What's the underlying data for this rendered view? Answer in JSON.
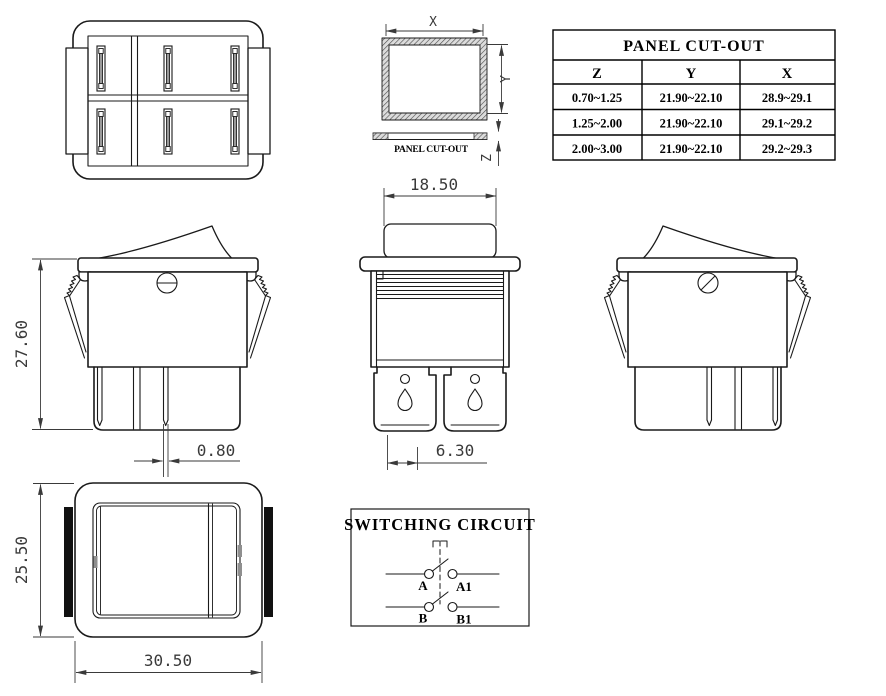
{
  "views": {
    "cutout_view": {
      "x_label": "X",
      "y_label": "Y",
      "z_label": "Z",
      "caption": "PANEL CUT-OUT"
    },
    "cutout_table": {
      "title": "PANEL CUT-OUT",
      "headers": [
        "Z",
        "Y",
        "X"
      ],
      "rows": [
        [
          "0.70~1.25",
          "21.90~22.10",
          "28.9~29.1"
        ],
        [
          "1.25~2.00",
          "21.90~22.10",
          "29.1~29.2"
        ],
        [
          "2.00~3.00",
          "21.90~22.10",
          "29.2~29.3"
        ]
      ]
    },
    "side_view": {
      "height": "27.60",
      "terminal_thickness": "0.80"
    },
    "front_view": {
      "rocker_width": "18.50",
      "terminal_width": "6.30"
    },
    "top_view": {
      "height": "25.50",
      "width": "30.50"
    },
    "circuit": {
      "title": "SWITCHING CIRCUIT",
      "labels": [
        "A",
        "A1",
        "B",
        "B1"
      ]
    }
  },
  "colors": {
    "line": "#1a1a1a",
    "dim_text": "#3a3a3a",
    "text": "#000000",
    "background": "#ffffff"
  }
}
